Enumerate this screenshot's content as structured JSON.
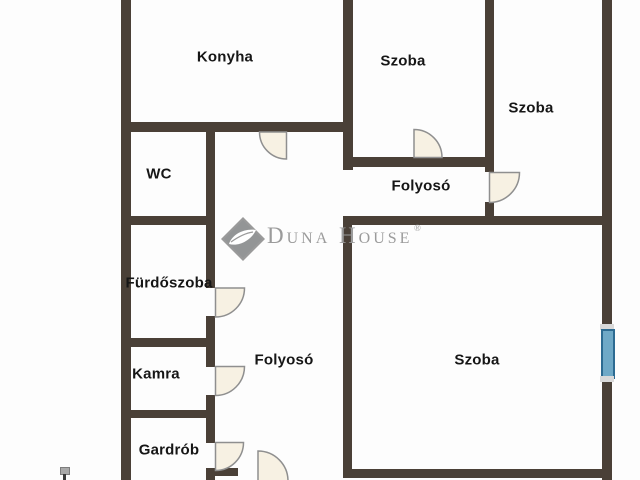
{
  "plan": {
    "title": "Apartment floor plan",
    "rooms": [
      {
        "id": "konyha",
        "label": "Konyha"
      },
      {
        "id": "szoba-top-middle",
        "label": "Szoba"
      },
      {
        "id": "szoba-top-right",
        "label": "Szoba"
      },
      {
        "id": "wc",
        "label": "WC"
      },
      {
        "id": "folyoso-upper",
        "label": "Folyosó"
      },
      {
        "id": "furdoszoba",
        "label": "Fürdőszoba"
      },
      {
        "id": "kamra",
        "label": "Kamra"
      },
      {
        "id": "folyoso-lower",
        "label": "Folyosó"
      },
      {
        "id": "szoba-large",
        "label": "Szoba"
      },
      {
        "id": "gardrob",
        "label": "Gardrób"
      }
    ],
    "watermark": {
      "brand": "Duna House",
      "registered_mark": "®"
    },
    "features": {
      "door_count": 7,
      "window_count": 1,
      "doors_at": [
        "Konyha",
        "Szoba (top middle)",
        "Szoba (top right)",
        "Fürdőszoba",
        "Kamra",
        "Gardrób",
        "entrance (bottom, partly cut off)"
      ],
      "window_at": "right wall of large Szoba"
    },
    "colors": {
      "background": "#fdfdfd",
      "wall": "#4a4037",
      "label": "#161616",
      "door_fill": "#f7f1e3",
      "door_stroke": "#8f8f8f",
      "window_fill": "#6fa9c7",
      "window_border": "#2d6b92",
      "watermark_gray": "#9b9b9b"
    }
  }
}
